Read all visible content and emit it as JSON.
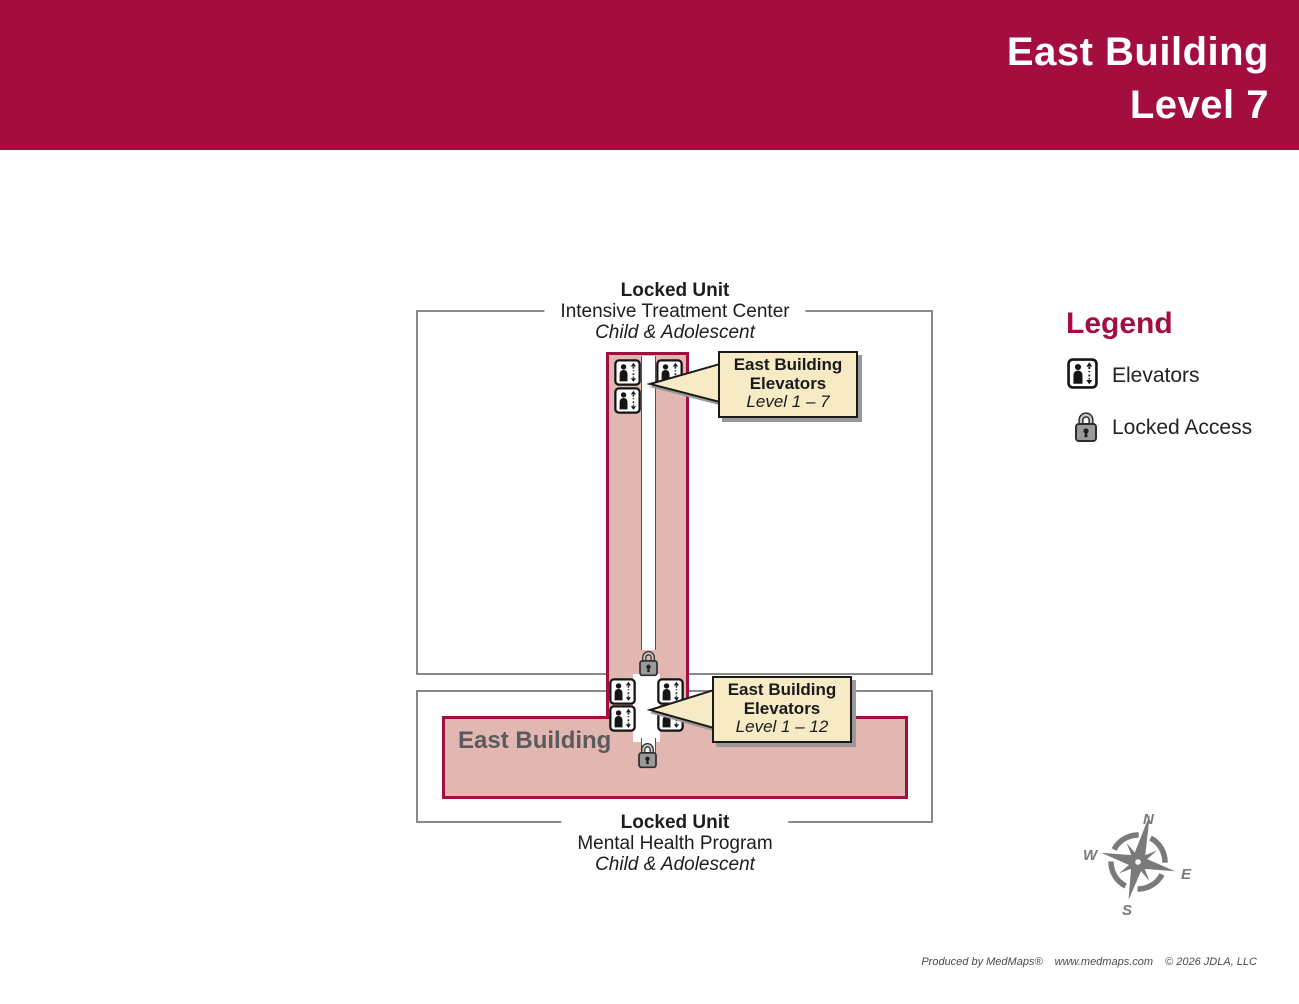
{
  "header": {
    "line1": "East Building",
    "line2": "Level 7"
  },
  "map": {
    "top_unit": {
      "title": "Locked Unit",
      "subtitle": "Intensive Treatment Center",
      "population": "Child & Adolescent"
    },
    "bottom_unit": {
      "title": "Locked Unit",
      "subtitle": "Mental Health Program",
      "population": "Child & Adolescent"
    },
    "building_label": "East Building",
    "callouts": [
      {
        "line1": "East Building",
        "line2": "Elevators",
        "line3": "Level 1 – 7"
      },
      {
        "line1": "East Building",
        "line2": "Elevators",
        "line3": "Level 1 – 12"
      }
    ]
  },
  "legend": {
    "title": "Legend",
    "items": [
      {
        "icon": "elevator-icon",
        "label": "Elevators"
      },
      {
        "icon": "lock-icon",
        "label": "Locked Access"
      }
    ]
  },
  "compass": {
    "north": "N",
    "east": "E",
    "south": "S",
    "west": "W"
  },
  "footer": {
    "produced_by": "Produced by MedMaps®",
    "website": "www.medmaps.com",
    "copyright": "© 2026 JDLA, LLC"
  },
  "colors": {
    "crimson": "#A40E3F",
    "pink_fill": "#E2B6B1",
    "callout_bg": "#F7EBC6",
    "outline_gray": "#8A8A8A",
    "building_text_gray": "#5B5B5B",
    "compass_gray": "#7A7A7A"
  }
}
